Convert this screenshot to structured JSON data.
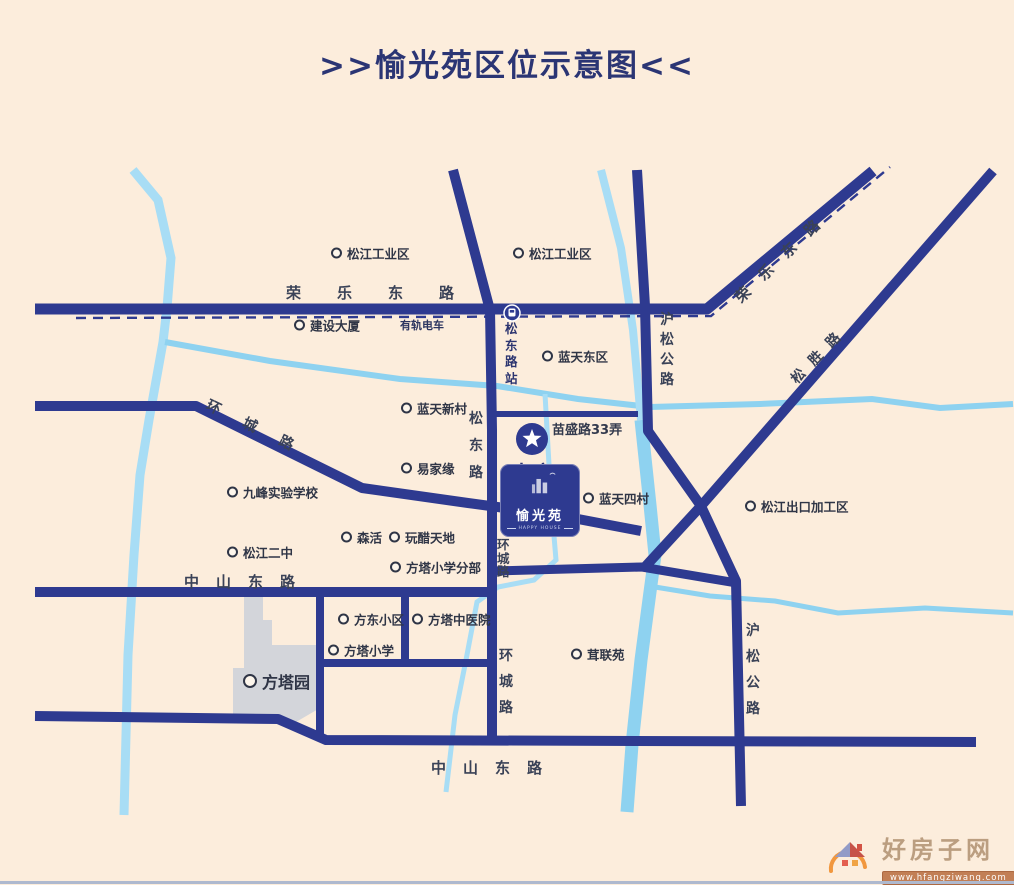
{
  "title": ">>愉光苑区位示意图<<",
  "project": {
    "marker_label": "本案",
    "logo_name": "愉光苑",
    "logo_subtitle": "HAPPY HOUSE"
  },
  "tram": {
    "line": "有轨电车",
    "station": "松东路站"
  },
  "roads": {
    "rongle_h": "荣乐东路",
    "rongle_diag": "荣乐东路",
    "songsheng": "松胜路",
    "husong_upper": "沪松公路",
    "husong_lower": "沪松公路",
    "songdong": "松东路",
    "huancheng_nw": "环城路",
    "huancheng_mid": "环城路",
    "huancheng_s": "环城路",
    "zhongshan_upper": "中山东路",
    "zhongshan_lower": "中山东路",
    "miaosheng": "苗盛路33弄"
  },
  "pois": [
    {
      "label": "松江工业区"
    },
    {
      "label": "松江工业区"
    },
    {
      "label": "建设大厦"
    },
    {
      "label": "蓝天东区"
    },
    {
      "label": "蓝天新村"
    },
    {
      "label": "易家缘"
    },
    {
      "label": "九峰实验学校"
    },
    {
      "label": "松江二中"
    },
    {
      "label": "森活"
    },
    {
      "label": "玩醋天地"
    },
    {
      "label": "方塔小学分部"
    },
    {
      "label": "蓝天四村"
    },
    {
      "label": "松江出口加工区"
    },
    {
      "label": "茸联苑"
    },
    {
      "label": "方东小区"
    },
    {
      "label": "方塔小学"
    },
    {
      "label": "方塔中医院"
    },
    {
      "label": "方塔园"
    }
  ],
  "watermark": {
    "site_name": "好房子网",
    "site_url": "www.hfangziwang.com"
  },
  "colors": {
    "background": "#fceddc",
    "road": "#2e3a90",
    "river": "#8ed2f0",
    "river_light": "#a8ddf5",
    "park": "#d3d5da",
    "accent_text": "#2c3574"
  }
}
